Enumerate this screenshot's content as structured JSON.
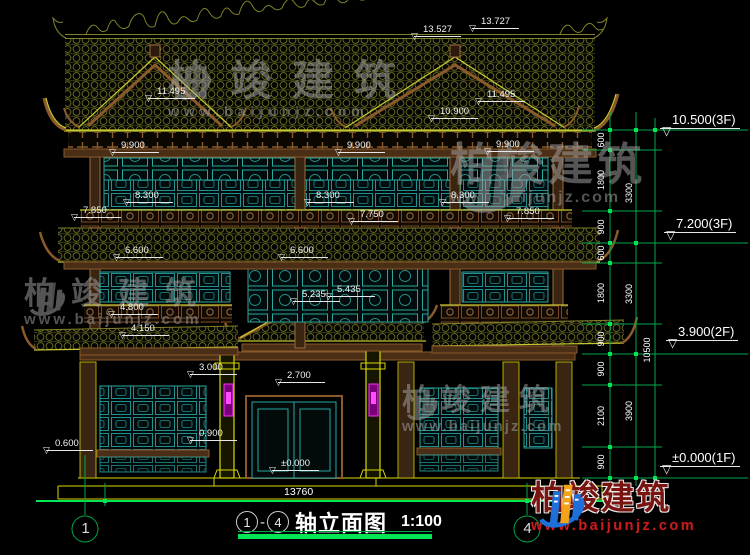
{
  "drawing": {
    "axis_start": "1",
    "separator": "-",
    "axis_end": "4",
    "title": "轴立面图",
    "scale": "1:100",
    "overall_width_dim": "13760"
  },
  "watermark": {
    "brand": "柏竣建筑",
    "url": "www.baijunjz.com"
  },
  "logo": {
    "brand": "柏竣建筑",
    "url": "www.baijunjz.com"
  },
  "colors": {
    "green": "#00a84a",
    "green_bright": "#00e655",
    "olive": "#81812a",
    "fascia": "#c6c832",
    "yellow": "#d8d800",
    "brown": "#8a5a2b",
    "brown_dark": "#4a2e15",
    "teal": "#2aa7a0",
    "magenta": "#ff2bff",
    "watermark": "#a9a9a9",
    "logo_blue": "#1e6fd9",
    "logo_orange": "#f5a21b",
    "logo_red": "#7a1410",
    "logo_red2": "#c81d1d",
    "text_white": "#ffffff"
  },
  "elevation_labels": [
    {
      "t": "13.527",
      "x": 414,
      "y": 24
    },
    {
      "t": "13.727",
      "x": 472,
      "y": 16
    },
    {
      "t": "11.495",
      "x": 148,
      "y": 86
    },
    {
      "t": "11.495",
      "x": 478,
      "y": 89
    },
    {
      "t": "10.900",
      "x": 431,
      "y": 106
    },
    {
      "t": "9.900",
      "x": 112,
      "y": 140
    },
    {
      "t": "9.900",
      "x": 338,
      "y": 140
    },
    {
      "t": "9.900",
      "x": 487,
      "y": 139
    },
    {
      "t": "8.300",
      "x": 126,
      "y": 190
    },
    {
      "t": "8.300",
      "x": 307,
      "y": 190
    },
    {
      "t": "8.300",
      "x": 442,
      "y": 190
    },
    {
      "t": "7.850",
      "x": 74,
      "y": 205
    },
    {
      "t": "7.750",
      "x": 351,
      "y": 209
    },
    {
      "t": "7.850",
      "x": 507,
      "y": 206
    },
    {
      "t": "6.600",
      "x": 116,
      "y": 245
    },
    {
      "t": "6.600",
      "x": 281,
      "y": 245
    },
    {
      "t": "5.235",
      "x": 293,
      "y": 289
    },
    {
      "t": "5.435",
      "x": 328,
      "y": 284
    },
    {
      "t": "4.800",
      "x": 111,
      "y": 302
    },
    {
      "t": "4.150",
      "x": 122,
      "y": 323
    },
    {
      "t": "3.000",
      "x": 190,
      "y": 362
    },
    {
      "t": "2.700",
      "x": 278,
      "y": 370
    },
    {
      "t": "0.900",
      "x": 190,
      "y": 428
    },
    {
      "t": "0.600",
      "x": 46,
      "y": 438
    },
    {
      "t": "±0.000",
      "x": 272,
      "y": 458
    }
  ],
  "floor_markers": [
    {
      "t": "10.500(3F)",
      "x": 660,
      "y": 112
    },
    {
      "t": "7.200(3F)",
      "x": 664,
      "y": 216
    },
    {
      "t": "3.900(2F)",
      "x": 666,
      "y": 324
    },
    {
      "t": "±0.000(1F)",
      "x": 660,
      "y": 450
    }
  ],
  "dim_texts": [
    {
      "t": "600",
      "x": 579,
      "y": 134
    },
    {
      "t": "1800",
      "x": 579,
      "y": 174
    },
    {
      "t": "900",
      "x": 579,
      "y": 221
    },
    {
      "t": "600",
      "x": 579,
      "y": 247
    },
    {
      "t": "1800",
      "x": 579,
      "y": 287
    },
    {
      "t": "900",
      "x": 579,
      "y": 333
    },
    {
      "t": "900",
      "x": 579,
      "y": 363
    },
    {
      "t": "2100",
      "x": 579,
      "y": 410
    },
    {
      "t": "900",
      "x": 579,
      "y": 456
    },
    {
      "t": "3300",
      "x": 607,
      "y": 187
    },
    {
      "t": "3300",
      "x": 607,
      "y": 288
    },
    {
      "t": "3900",
      "x": 607,
      "y": 405
    },
    {
      "t": "10500",
      "x": 625,
      "y": 344
    }
  ],
  "axis_bubbles": [
    {
      "t": "1",
      "x": 79,
      "y": 520
    },
    {
      "t": "4",
      "x": 521,
      "y": 520
    }
  ]
}
